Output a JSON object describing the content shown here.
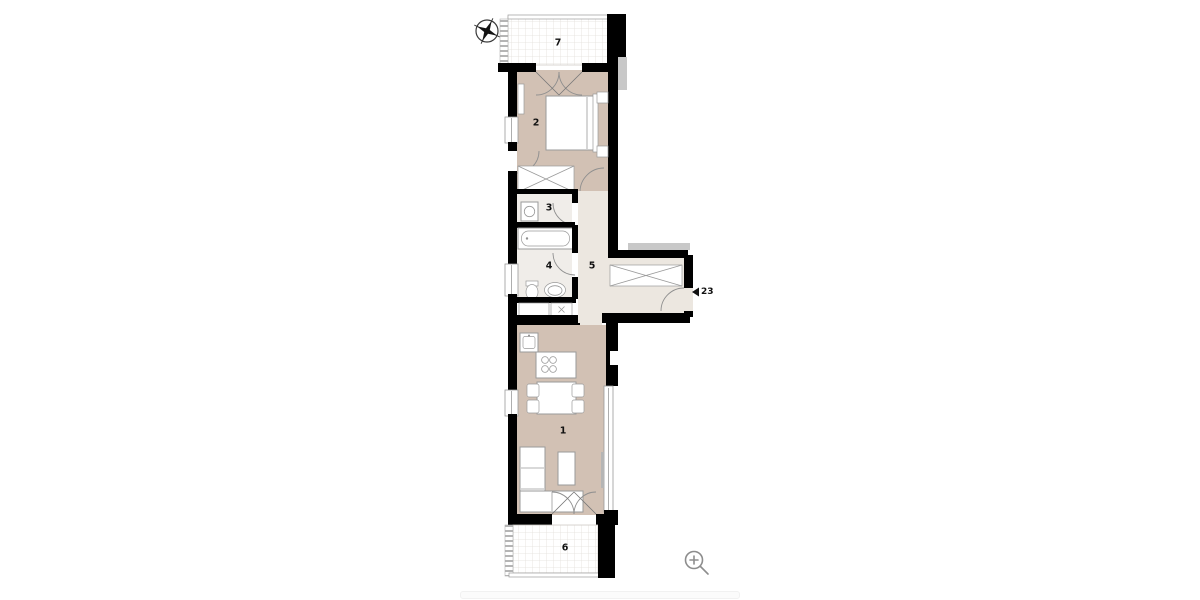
{
  "title": "Apartment floor plan",
  "rooms": [
    {
      "number": "1"
    },
    {
      "number": "2"
    },
    {
      "number": "3"
    },
    {
      "number": "4"
    },
    {
      "number": "5"
    },
    {
      "number": "6"
    },
    {
      "number": "7"
    }
  ],
  "entrance": {
    "unit_number": "23"
  },
  "icons": {
    "compass": "north-arrow-icon",
    "zoom": "zoom-in-icon"
  },
  "colors": {
    "wall": "#000000",
    "room_floor": "#d2c1b4",
    "hall_floor": "#ece7e0",
    "bath_floor": "#f0ede9",
    "outline": "#9a9a9a",
    "shadow": "#c8c8c8",
    "grid_line": "#e2dfda",
    "icon": "#8d8d8d"
  }
}
